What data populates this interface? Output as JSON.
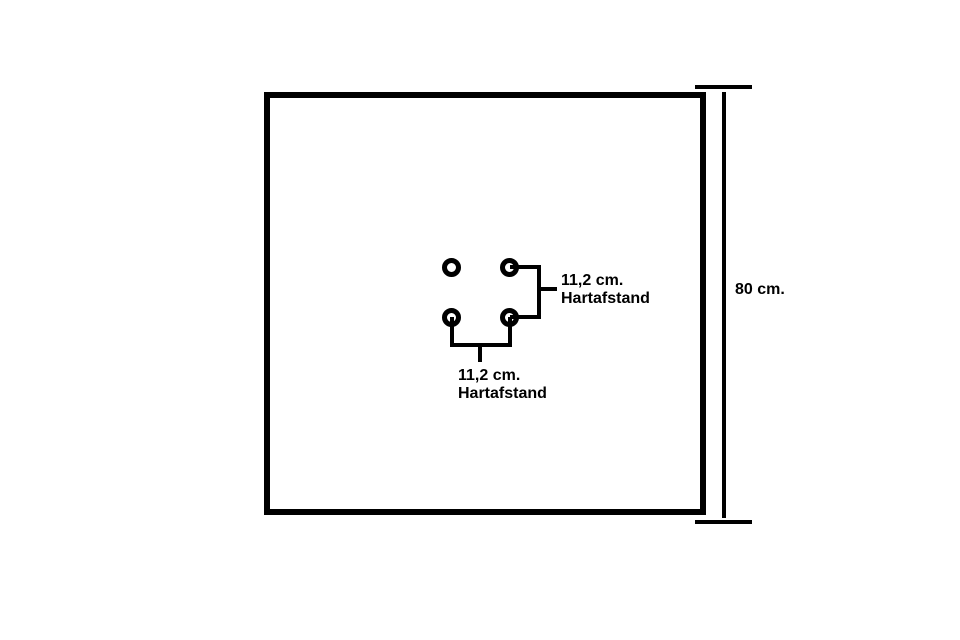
{
  "figure": {
    "type": "technical-diagram",
    "colors": {
      "ink": "#000000",
      "background": "#ffffff"
    },
    "plate": {
      "shape": "square",
      "height_label": "80 cm."
    },
    "holes": {
      "count": 4,
      "pattern": "2x2"
    },
    "dimensions": {
      "plate_height": {
        "value": "80 cm."
      },
      "vertical_pitch": {
        "value": "11,2 cm.",
        "caption": "Hartafstand"
      },
      "horizontal_pitch": {
        "value": "11,2 cm.",
        "caption": "Hartafstand"
      }
    }
  }
}
